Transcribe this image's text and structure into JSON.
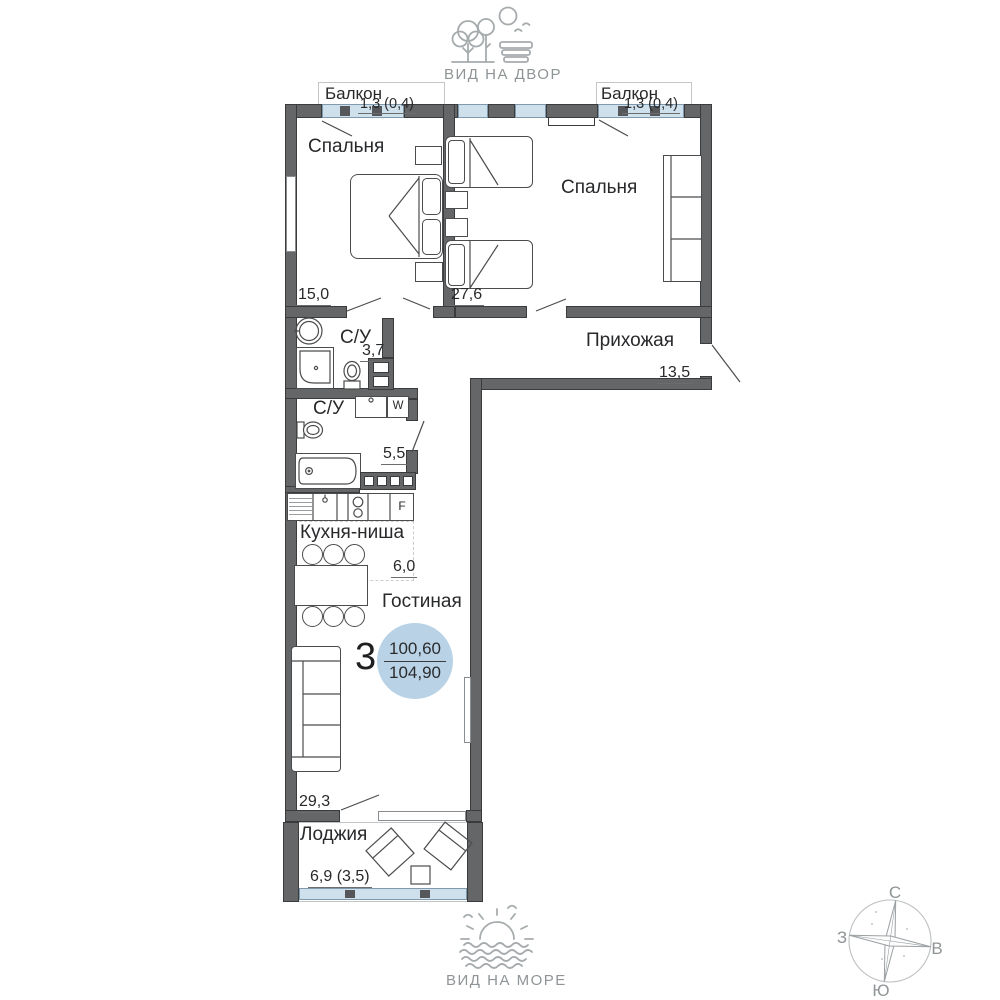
{
  "header": {
    "label": "ВИД НА ДВОР"
  },
  "footer": {
    "label": "ВИД НА МОРЕ"
  },
  "apartment": {
    "rooms_count": "3",
    "area_living": "100,60",
    "area_total": "104,90"
  },
  "rooms": {
    "balcony_left": {
      "name": "Балкон",
      "area": "1,3 (0,4)"
    },
    "balcony_right": {
      "name": "Балкон",
      "area": "1,3 (0,4)"
    },
    "bedroom_left": {
      "name": "Спальня",
      "area": "15,0"
    },
    "bedroom_right": {
      "name": "Спальня",
      "area": "27,6"
    },
    "hallway": {
      "name": "Прихожая",
      "area": "13,5"
    },
    "bathroom_small": {
      "name": "С/У",
      "area": "3,7"
    },
    "bathroom_large": {
      "name": "С/У",
      "area": "5,5"
    },
    "kitchen_niche": {
      "name": "Кухня-ниша",
      "area": "6,0"
    },
    "living_room": {
      "name": "Гостиная",
      "area": "29,3"
    },
    "loggia": {
      "name": "Лоджия",
      "area": "6,9 (3,5)"
    }
  },
  "appliances": {
    "washer": "W",
    "fridge": "F"
  },
  "compass": {
    "north": "С",
    "south": "Ю",
    "west": "З",
    "east": "В"
  },
  "colors": {
    "wall": "#646668",
    "glazing": "#cfe0ed",
    "area_circle": "#b9d2e5",
    "icon": "#a6abad"
  }
}
